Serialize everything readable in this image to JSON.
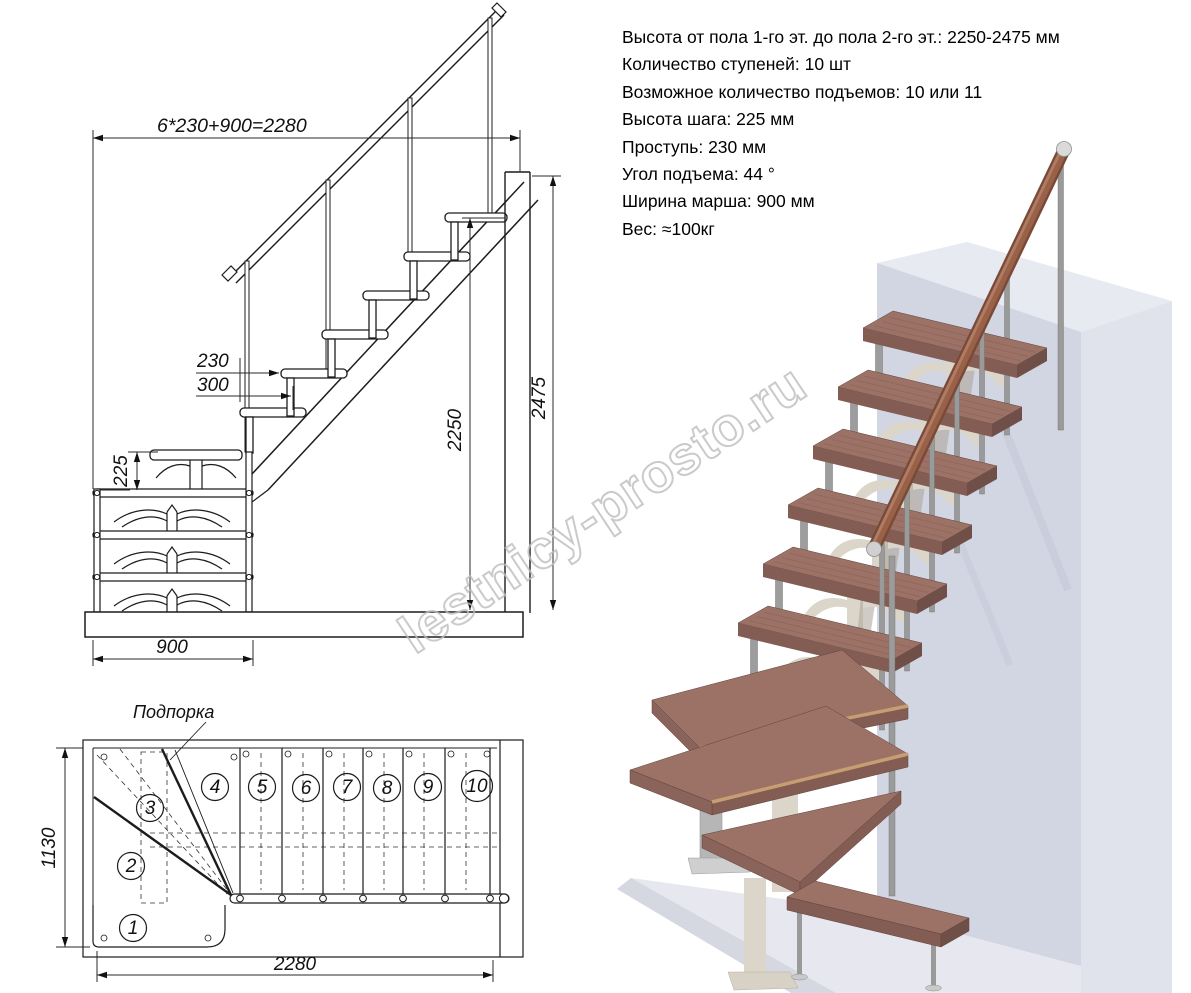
{
  "specs": {
    "lines": [
      "Высота от пола 1-го эт. до пола 2-го эт.: 2250-2475 мм",
      "Количество ступеней: 10 шт",
      "Возможное количество подъемов: 10 или 11",
      "Высота шага: 225 мм",
      "Проступь: 230 мм",
      "Угол подъема: 44 °",
      "Ширина марша: 900 мм",
      "Вес: ≈100кг"
    ]
  },
  "watermark": {
    "text": "lestnicy-prosto.ru"
  },
  "elevation": {
    "dim_total_top": "6*230+900=2280",
    "dim_tread": "230",
    "dim_nose": "300",
    "dim_riser": "225",
    "dim_height_min": "2250",
    "dim_height_max": "2475",
    "dim_width": "900"
  },
  "plan": {
    "support_label": "Подпорка",
    "dim_depth": "1130",
    "dim_length": "2280",
    "step_numbers": [
      "1",
      "2",
      "3",
      "4",
      "5",
      "6",
      "7",
      "8",
      "9",
      "10"
    ]
  },
  "colors": {
    "line": "#1c1c1c",
    "wood_tread": "#9c7266",
    "wood_handrail": "#7a4a39",
    "metal": "#9a9a9a",
    "spine_cream": "#dcd6ca",
    "wall": "#d2d5e2",
    "floor": "#e7e8ef",
    "watermark": "#bdbdbd"
  }
}
